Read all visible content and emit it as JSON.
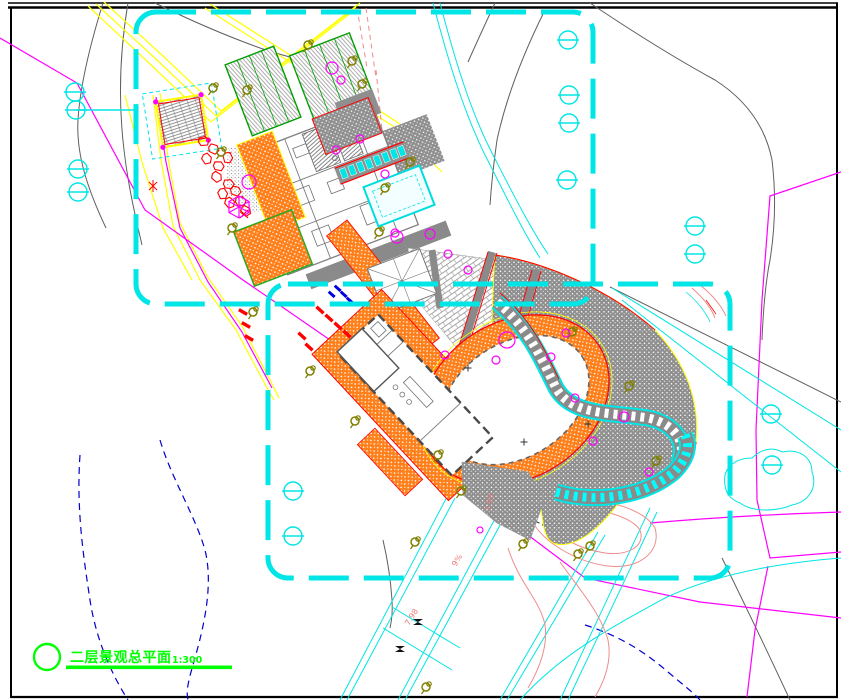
{
  "drawing": {
    "title": "二层景观总平面",
    "scale": "1:300"
  },
  "annotations": {
    "grade_a": "7.98",
    "grade_b": "7.99",
    "slope": "9%"
  },
  "palette": {
    "viewport_cyan": "#00e5e5",
    "paving_orange": "#ff7f1a",
    "title_green": "#00ff00",
    "road_yellow": "#ffff00",
    "contour_magenta": "#ff00ff",
    "contour_pink": "#ef8b8b",
    "contour_blue": "#0000cd",
    "stone_red": "#ff0000",
    "paving_gray": "#8f8f8f",
    "ink_black": "#000000"
  }
}
